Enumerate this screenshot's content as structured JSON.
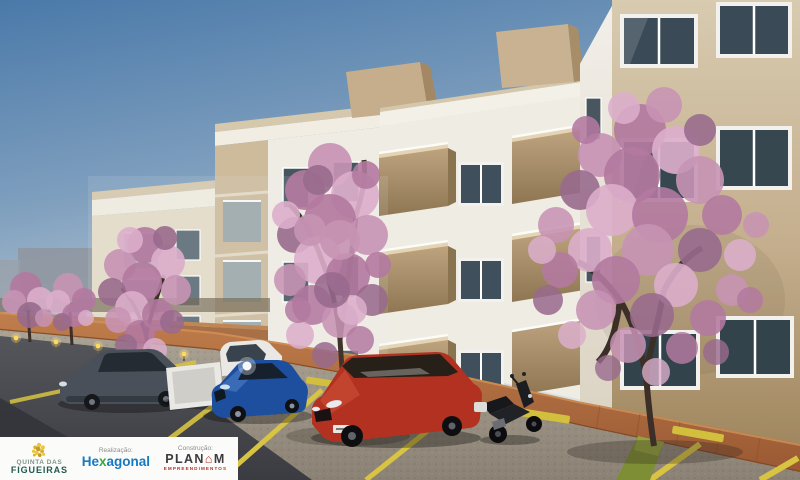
{
  "meta": {
    "type": "architectural-render",
    "title": "Quinta das Figueiras condominium exterior rendering"
  },
  "scene": {
    "description": "3D render of four-storey beige and white apartment blocks with projecting taupe balconies, pink-blossom trees, a brick walkway, bollard path lights and angled parking stalls with vehicles under a clear blue sky.",
    "sky": {
      "top": "#4a79a9",
      "horizon": "#dee4e8"
    },
    "palette": {
      "facade_white": "#efece3",
      "facade_beige": "#cdbb9c",
      "near_facade_top": "#d8cbb0",
      "near_facade_bottom": "#a0875f",
      "balcony_taupe": "#b49a76",
      "window_glass": "#3a4b57",
      "window_frame": "#f2f1ed",
      "blossom_pink": "#c793b4",
      "trunk_brown": "#3c2f28",
      "brick_path": "#b06a3e",
      "cobblestone": "#a19889",
      "asphalt": "#4e4f53",
      "marking_yellow": "#d8c342",
      "grass_green": "#7e8e34",
      "path_light": "#ffd95e"
    },
    "vehicles": [
      {
        "name": "gray-sedan",
        "color": "#49505a"
      },
      {
        "name": "white-pickup",
        "color": "#e9e8e4"
      },
      {
        "name": "blue-sedan",
        "color": "#1d4f9e"
      },
      {
        "name": "red-hatchback",
        "color": "#b23120"
      },
      {
        "name": "black-scooter",
        "color": "#17181b"
      }
    ],
    "trees": [
      {
        "name": "far-left-small-tree-1"
      },
      {
        "name": "far-left-small-tree-2"
      },
      {
        "name": "left-tree"
      },
      {
        "name": "center-tree"
      },
      {
        "name": "right-tree"
      }
    ]
  },
  "footer": {
    "project": {
      "line1": "QUINTA DAS",
      "line2": "FIGUEIRAS"
    },
    "realizacao": {
      "label": "Realização:",
      "brand_start": "He",
      "brand_x": "x",
      "brand_end": "agonal"
    },
    "construcao": {
      "label": "Construção:",
      "brand_start": "PLAN",
      "brand_o": "⌂",
      "brand_end": "M",
      "subtitle": "EMPREENDIMENTOS"
    }
  }
}
